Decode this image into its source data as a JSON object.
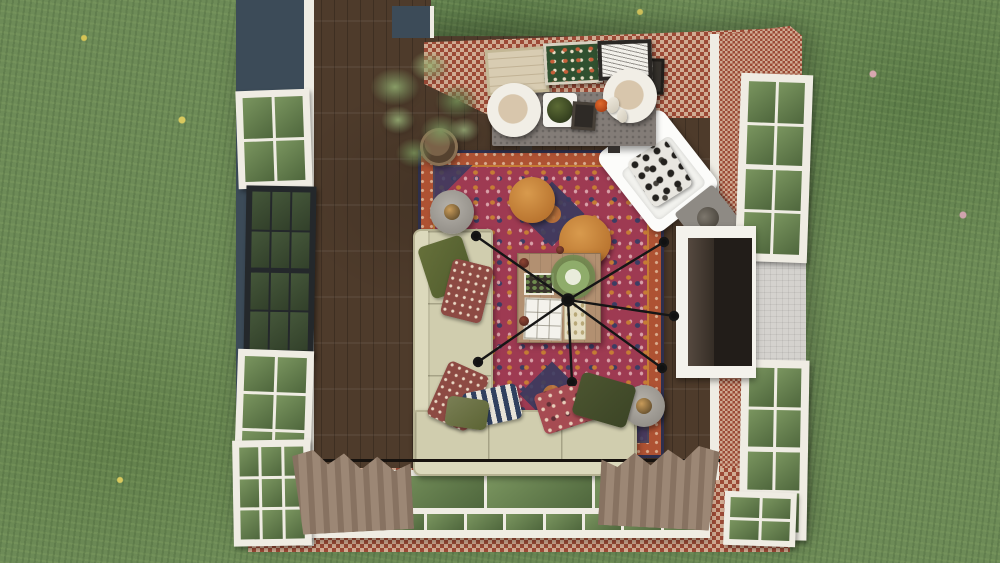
{
  "scene": {
    "view": "top-down 3d render",
    "room": "Living room",
    "environment": "Grass lawn with scattered wildflowers"
  },
  "palette": {
    "grass": "#6d8b57",
    "floor": "#4e3b2b",
    "wall_navy": "#3c4b58",
    "trim": "#efece3",
    "brick": "#a4553c",
    "chimney": "#d4d2ce",
    "window_black": "#24282b",
    "rug_border": "#ae5233",
    "rug_field": "#9e3a52",
    "rug_navy": "#3a3b5f",
    "rug_accent": "#c67c35",
    "sofa": "#d0cdae",
    "pouf": "#b9742f",
    "wood_table": "#b29071",
    "console": "#837c77",
    "curtain": "#9c8775",
    "lamp_shade": "#f1eee6",
    "lamp_inner": "#d8c6ac",
    "tv_dark": "#221d19"
  },
  "objects": {
    "lawn": {
      "label": "Grass lawn"
    },
    "floor": {
      "label": "Dark walnut plank floor"
    },
    "left_wall": {
      "label": "Navy exterior wall"
    },
    "brick_wall": {
      "label": "Red brick exterior wall"
    },
    "chimney": {
      "label": "Chimney cap"
    },
    "window_white": {
      "label": "White double-hung window"
    },
    "window_black": {
      "label": "Black-frame picture window"
    },
    "window_wall": {
      "label": "Glazed window wall"
    },
    "curtain": {
      "label": "Taupe drapery panel"
    },
    "rug": {
      "label": "Red oriental area rug"
    },
    "sofa": {
      "label": "Beige sectional sofa"
    },
    "pillow": {
      "label": "Throw pillow"
    },
    "pouf": {
      "label": "Orange round pouf"
    },
    "side_table": {
      "label": "Round grey side table"
    },
    "coffee_table": {
      "label": "Square wood coffee table"
    },
    "chandelier": {
      "label": "Black spider-arm chandelier"
    },
    "armchair": {
      "label": "White accent armchair"
    },
    "accent_table": {
      "label": "Square accent table"
    },
    "fireplace": {
      "label": "Fireplace with TV"
    },
    "console": {
      "label": "Concrete media console"
    },
    "lamp": {
      "label": "Drum-shade table lamp"
    },
    "artwork": {
      "label": "Leaning framed artwork"
    },
    "plant": {
      "label": "Potted houseplant"
    }
  }
}
